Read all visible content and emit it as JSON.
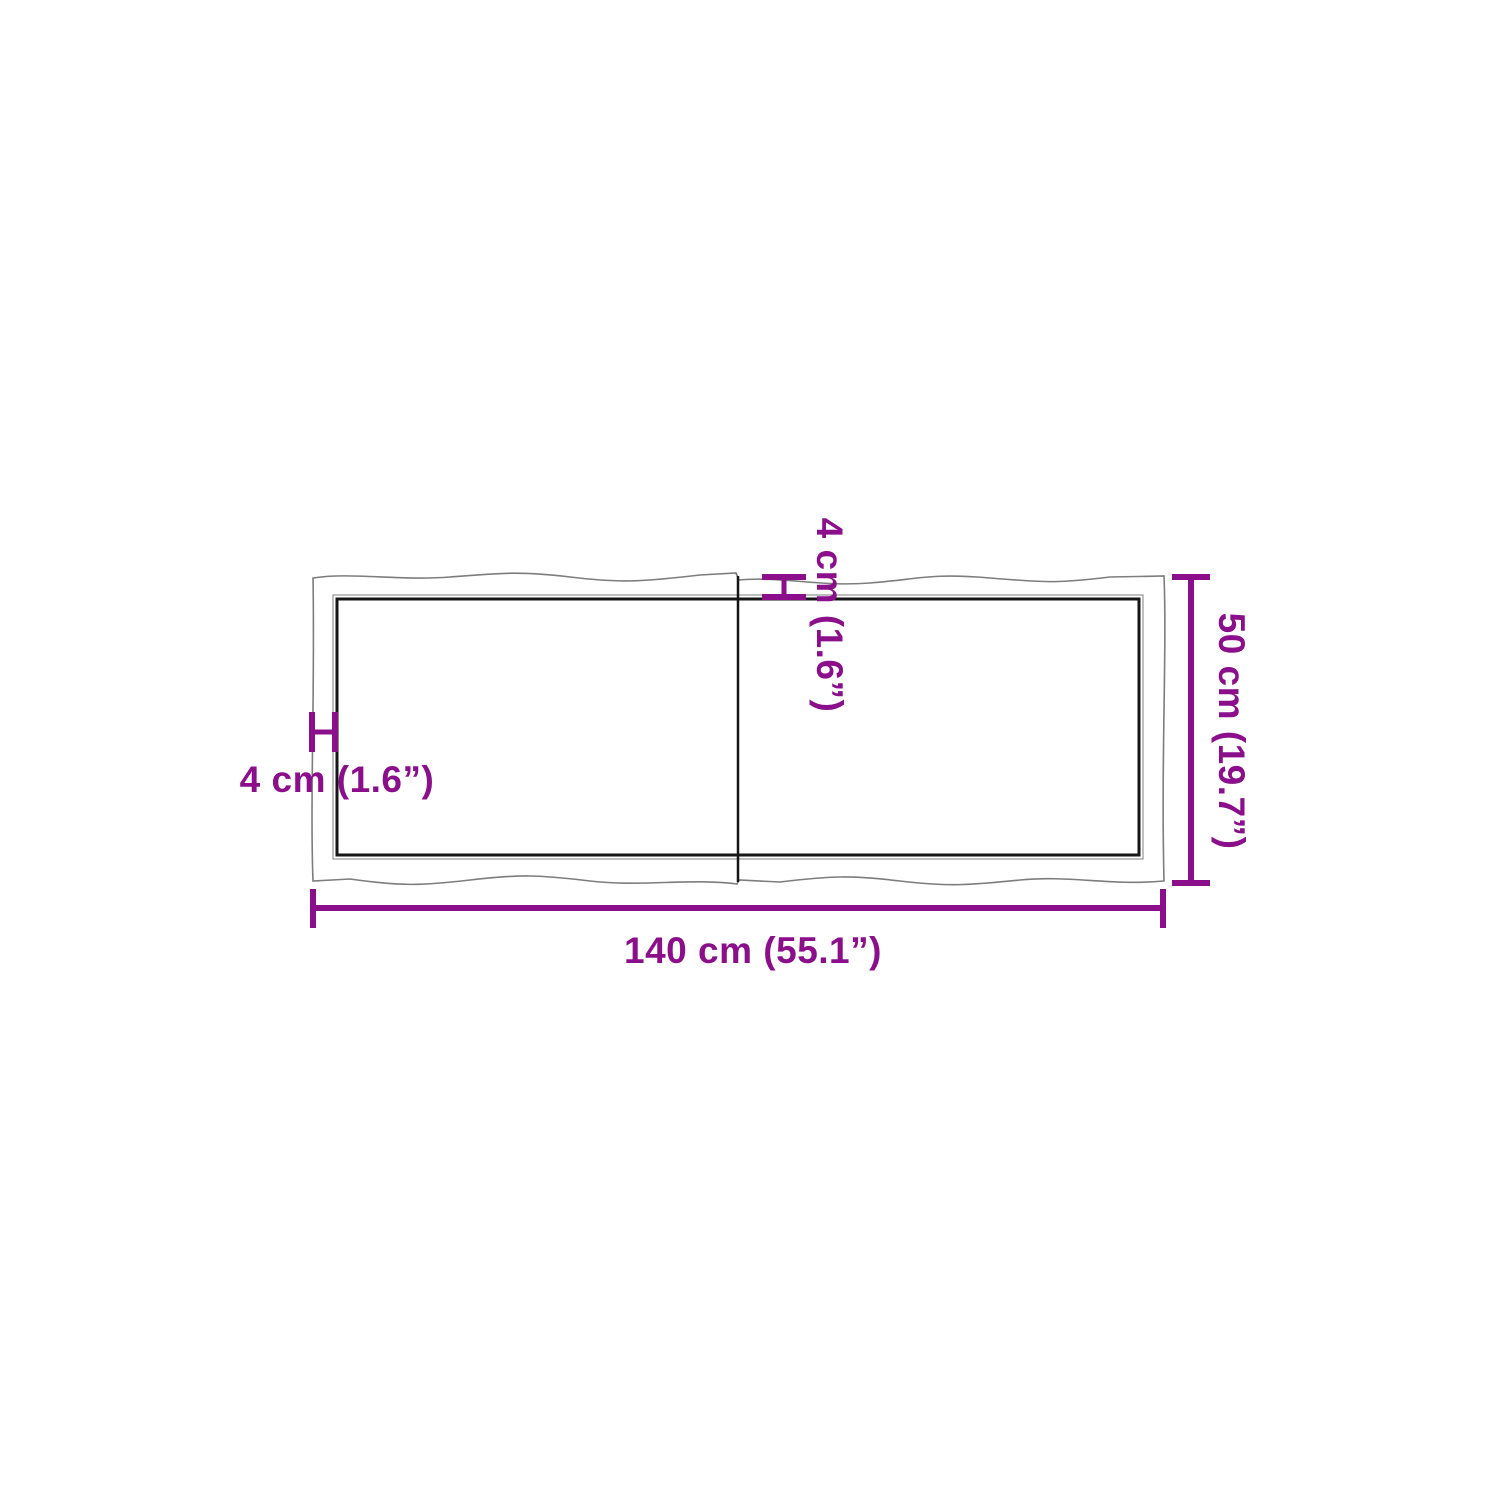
{
  "page": {
    "background": "#ffffff"
  },
  "colors": {
    "dimension": "#8B0F8B",
    "edge": "#7d7d7d",
    "board": "#161616"
  },
  "diagram": {
    "type": "product-dimension-diagram",
    "subject": "live-edge two-piece table top, top view",
    "labels": {
      "width": "140 cm (55.1”)",
      "height": "50 cm (19.7”)",
      "thickness_left": "4 cm (1.6”)",
      "thickness_top": "4 cm (1.6”)"
    },
    "dimensions": {
      "width_cm": 140,
      "width_in": 55.1,
      "height_cm": 50,
      "height_in": 19.7,
      "thickness_cm": 4,
      "thickness_in": 1.6
    }
  }
}
